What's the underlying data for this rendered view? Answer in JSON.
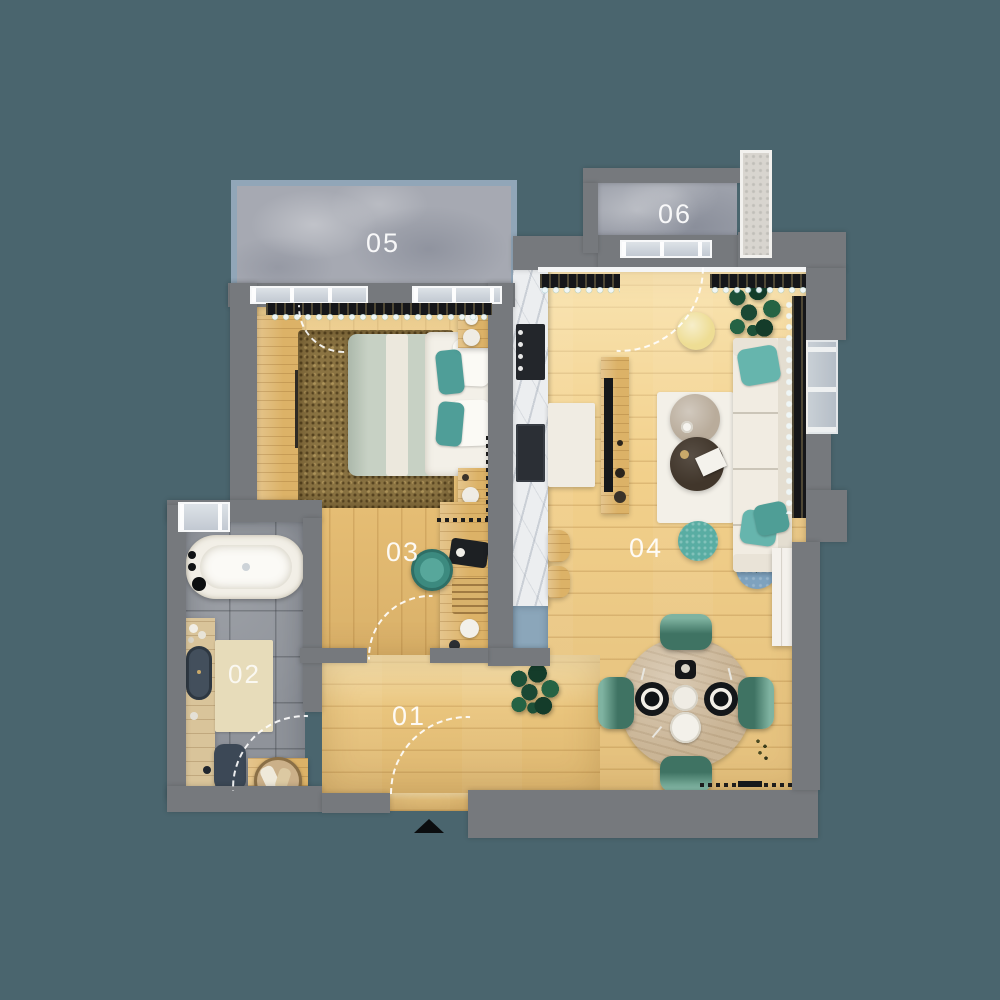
{
  "scene": {
    "type": "apartment floor plan, top-down 3D render",
    "background_color": "#4a656e"
  },
  "rooms": [
    {
      "label": "01",
      "name": "hallway",
      "floor": "light oak wood",
      "furniture": [
        "entrance door swing",
        "entrance marker triangle"
      ]
    },
    {
      "label": "02",
      "name": "bathroom",
      "floor": "gray tile",
      "furniture": [
        "bathtub",
        "wood vanity with dark basin",
        "toilet",
        "bath mat",
        "towel basket on wood platform",
        "window"
      ]
    },
    {
      "label": "03",
      "name": "bedroom",
      "floor": "light oak wood",
      "furniture": [
        "double bed with sage duvet and teal pillows",
        "brown shag rug",
        "wardrobe",
        "two nightstands with lamps",
        "desk with accessories",
        "teal stool",
        "balcony door swing"
      ]
    },
    {
      "label": "04",
      "name": "living room with kitchenette and dining area",
      "floor": "light oak wood",
      "furniture": [
        "cream sofa with teal cushions",
        "white rug",
        "two round coffee tables",
        "yellow pouf",
        "teal pouf",
        "blue side table",
        "tv bench",
        "marble kitchen counter with cooktop and sink",
        "two bar stools",
        "white island",
        "round dining table with four green chairs",
        "two potted plants",
        "white shelf",
        "balcony door swing"
      ]
    },
    {
      "label": "05",
      "name": "balcony",
      "floor": "stone",
      "furniture": [
        "railing"
      ]
    },
    {
      "label": "06",
      "name": "balcony",
      "floor": "stone",
      "furniture": [
        "stone column"
      ]
    }
  ],
  "markers": {
    "entrance": "black triangle at main entrance door, bottom center"
  },
  "palette": {
    "background": "#4a656e",
    "wall": "#76797d",
    "wood_floor": "#eec981",
    "stone_balcony": "#a6a9b2",
    "tile_bathroom": "#8f939a",
    "accent_teal": "#57a79b",
    "sofa_cream": "#f1ece2",
    "dining_chair_green": "#4a8472",
    "plant_green": "#1d5038",
    "label_color": "#ffffff"
  }
}
